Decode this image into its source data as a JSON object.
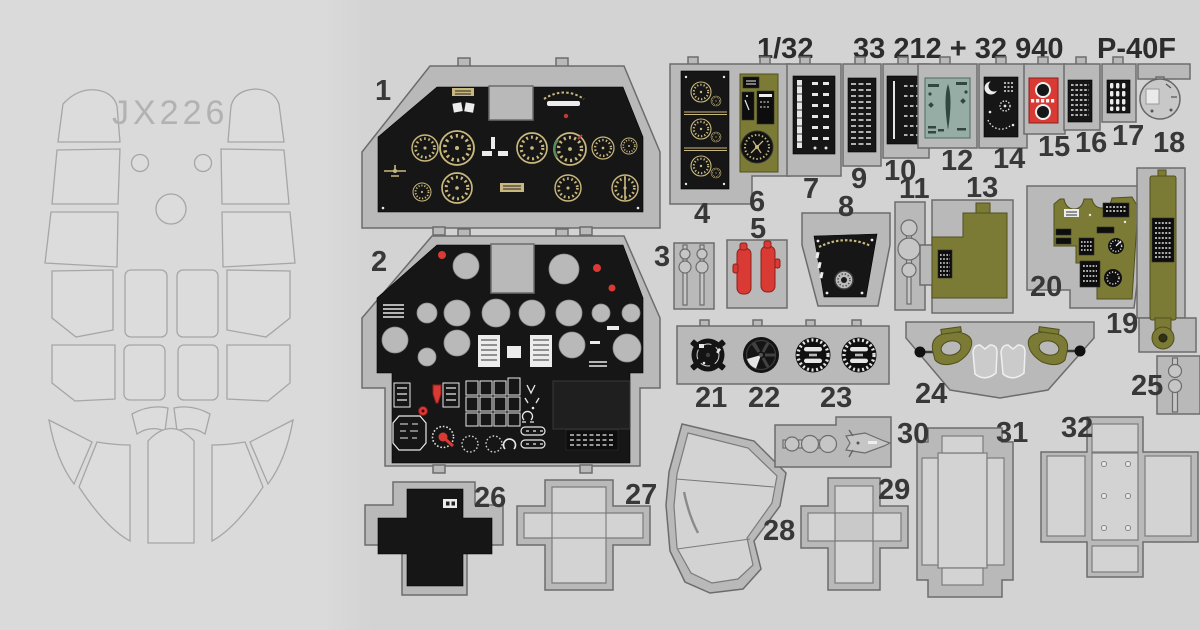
{
  "title": {
    "scale": "1/32",
    "catalog": "33 212 + 32 940",
    "aircraft": "P-40F"
  },
  "mask_sheet": {
    "code": "JX226"
  },
  "parts": [
    {
      "label": "1"
    },
    {
      "label": "2"
    },
    {
      "label": "3"
    },
    {
      "label": "4"
    },
    {
      "label": "5"
    },
    {
      "label": "6"
    },
    {
      "label": "7"
    },
    {
      "label": "8"
    },
    {
      "label": "9"
    },
    {
      "label": "10"
    },
    {
      "label": "11"
    },
    {
      "label": "12"
    },
    {
      "label": "13"
    },
    {
      "label": "14"
    },
    {
      "label": "15"
    },
    {
      "label": "16"
    },
    {
      "label": "17"
    },
    {
      "label": "18"
    },
    {
      "label": "19"
    },
    {
      "label": "20"
    },
    {
      "label": "21"
    },
    {
      "label": "22"
    },
    {
      "label": "23"
    },
    {
      "label": "24"
    },
    {
      "label": "25"
    },
    {
      "label": "26"
    },
    {
      "label": "27"
    },
    {
      "label": "28"
    },
    {
      "label": "29"
    },
    {
      "label": "30"
    },
    {
      "label": "31"
    },
    {
      "label": "32"
    }
  ],
  "colors": {
    "bg": "#d3d3d3",
    "sheet": "#dadada",
    "fret": "#b9b9b9",
    "edge": "#6c6c6c",
    "black": "#161616",
    "olive": "#7c7b35",
    "red": "#d93a33",
    "teal": "#95ada5",
    "tan": "#c9b87d",
    "metal": "#c6c6c6",
    "num": "#383838",
    "maskline": "#a6a6a6"
  }
}
